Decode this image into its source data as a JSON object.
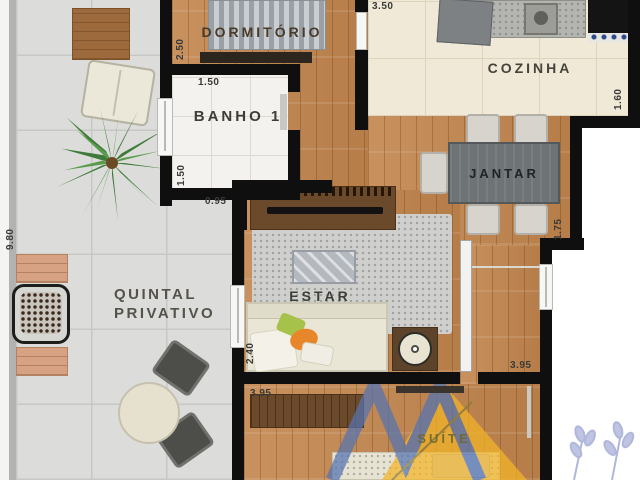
{
  "plan_title": "Apartment floor plan",
  "labels": {
    "dormitorio": "DORMITÓRIO",
    "banho": "BANHO 1",
    "cozinha": "COZINHA",
    "jantar": "JANTAR",
    "estar": "ESTAR",
    "suite": "SUÍTE",
    "quintal_line1": "QUINTAL",
    "quintal_line2": "PRIVATIVO"
  },
  "dimensions": {
    "dormitorio_left": "2.50",
    "banho_top": "1.50",
    "banho_left": "1.50",
    "banho_door": "0.95",
    "cozinha_top": "3.50",
    "cozinha_right": "1.60",
    "jantar_right": "1.75",
    "quintal_left": "9.80",
    "estar_left": "2.40",
    "suite_top": "3.95",
    "corridor_right": "3.95"
  },
  "colors": {
    "wall": "#0f0f0f",
    "wood_floor": "#c18a56",
    "kitchen_floor": "#f0e9d8",
    "tile_floor": "#dcdcda",
    "bath_floor": "#f4f2ee",
    "watermark_blue": "#5574b2",
    "watermark_yellow": "#f4b527",
    "flower_lavender": "#a3abd5"
  }
}
